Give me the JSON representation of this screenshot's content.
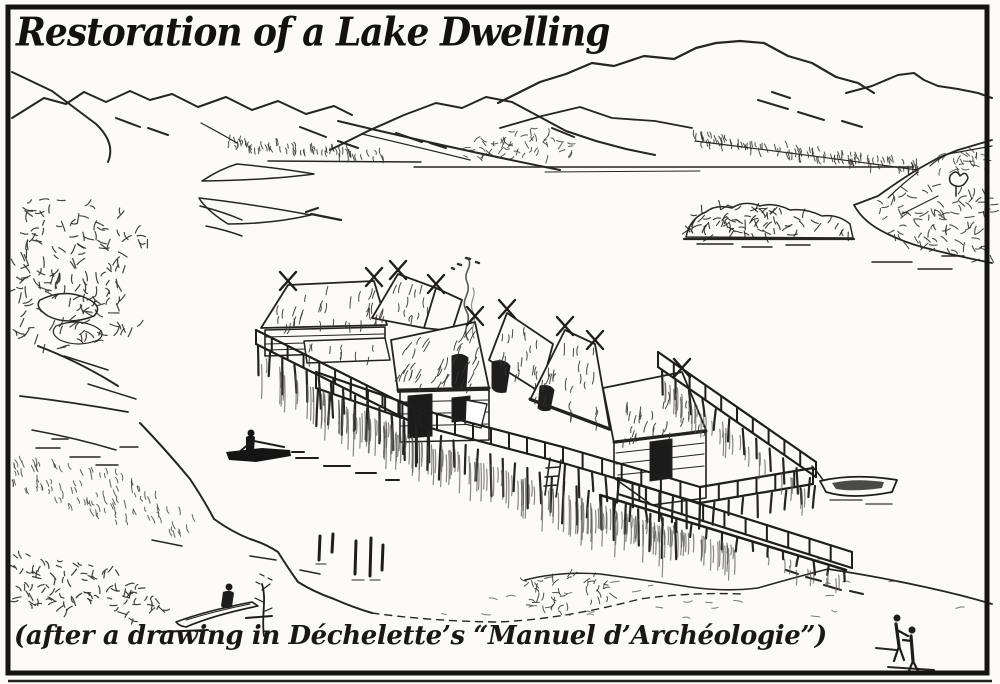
{
  "figure": {
    "title": "Restoration of a Lake Dwelling",
    "caption": "(after a drawing in Déchelette’s “Manuel d’Archéologie”)",
    "medium": "black-and-white pen-and-ink book illustration",
    "ink_color": "#1c1c1c",
    "paper_color": "#fbfaf6",
    "scene": {
      "setting": "prehistoric pile-dwelling village on a lake, mountains beyond",
      "elements": [
        "mountain ranges on the horizon",
        "wooded far shore of the lake",
        "tree-covered island",
        "rocky wooded headland on the left",
        "cluster of thatched huts on a timber platform over the water",
        "crossed gable poles on the hut roofs",
        "hearth smoke rising from the village",
        "railed walkways on piles with reflections",
        "footbridge leading from the platform to the beach",
        "old pile stumps standing in the water",
        "paddler in a dugout canoe on the lake",
        "beached dugout canoe with a seated figure",
        "dugout canoe moored at the platform",
        "two figures standing on the sandy foreshore"
      ]
    }
  }
}
